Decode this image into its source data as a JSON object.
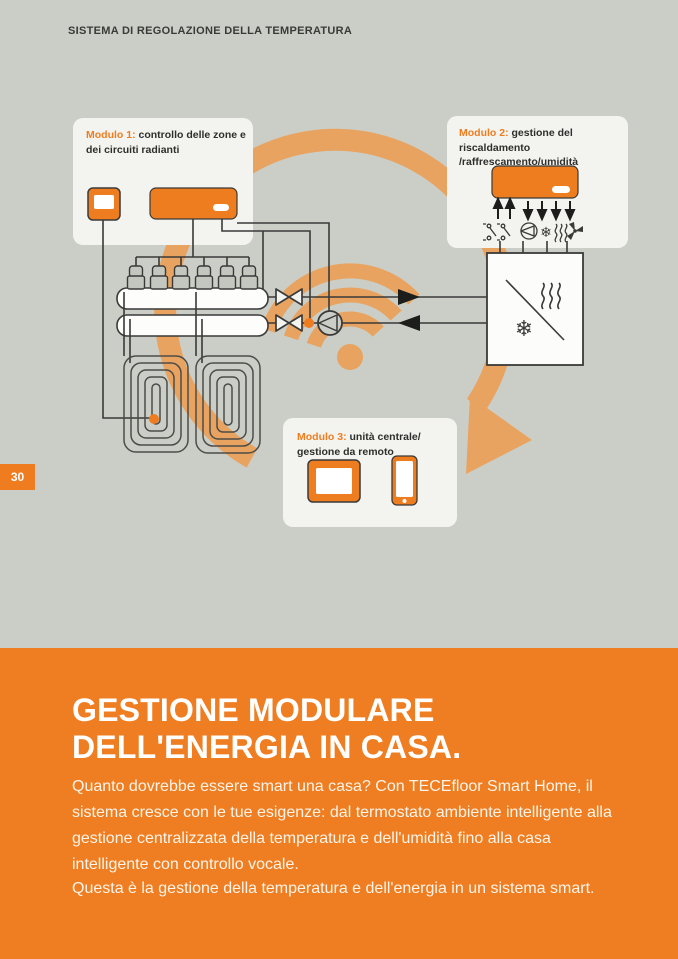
{
  "page": {
    "header": "SISTEMA DI REGOLAZIONE DELLA TEMPERATURA",
    "page_number": "30",
    "colors": {
      "background": "#cbcec7",
      "accent_orange": "#ef7d20",
      "arc_orange": "#e8a360",
      "panel": "#f3f4f0",
      "line": "#3a3a38",
      "footer_background": "#ef7e22"
    }
  },
  "diagram": {
    "module1": {
      "label": "Modulo 1:",
      "text": "controllo delle zone e dei circuiti radianti",
      "devices": [
        "room-thermostat",
        "wiring-center"
      ]
    },
    "module2": {
      "label": "Modulo 2:",
      "text": "gestione del riscaldamento /raffrescamento/umidità",
      "devices": [
        "climate-controller"
      ],
      "icons": [
        "relay-contact",
        "relay-contact",
        "pump",
        "snowflake",
        "heat-waves",
        "fan"
      ]
    },
    "module3": {
      "label": "Modulo 3:",
      "text": "unità centrale/ gestione da remoto",
      "devices": [
        "central-unit-tablet",
        "smartphone"
      ]
    },
    "symbols": {
      "snowflake_glyph": "❄",
      "wifi": "wifi-signal",
      "flow_arrow": "circular-flow-arrow",
      "heat_pump": "heating-cooling-unit",
      "manifold": "radiant-circuit-manifold",
      "floor_coils": [
        "floor-heating-coil",
        "floor-heating-coil"
      ]
    }
  },
  "footer": {
    "title_line1": "GESTIONE MODULARE",
    "title_line2": "DELL'ENERGIA IN CASA.",
    "paragraph1": "Quanto dovrebbe essere smart una casa? Con TECEfloor Smart Home, il sistema cresce con le tue esigenze: dal termostato ambiente intelligente alla gestione centralizzata della temperatura e dell'umidità fino alla casa intelligente con controllo vocale.",
    "paragraph2": "Questa è la gestione della temperatura e dell'energia in un sistema smart."
  }
}
